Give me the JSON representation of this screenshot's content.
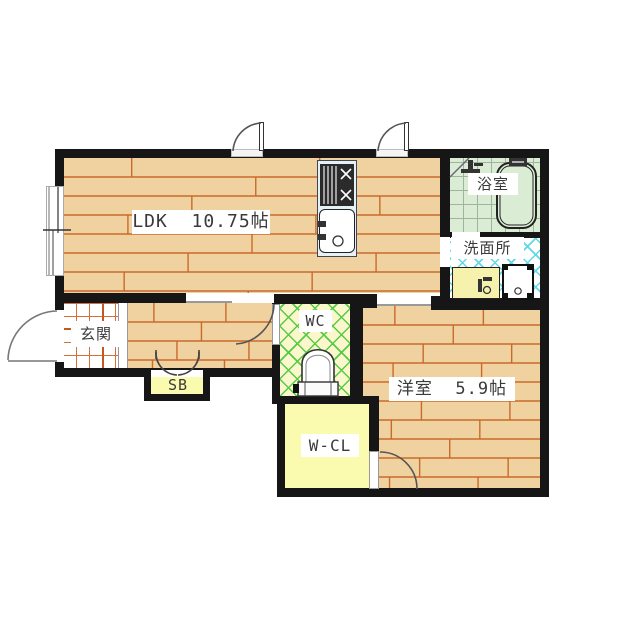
{
  "plan": {
    "rooms": {
      "ldk": {
        "label": "LDK  10.75帖",
        "floor": "wood-flooring"
      },
      "bathroom": {
        "label": "浴室",
        "floor": "tile-grid"
      },
      "washroom": {
        "label": "洗面所",
        "floor": "cyan-lattice"
      },
      "entrance": {
        "label": "玄関",
        "floor": "tile-grid"
      },
      "shoe_box": {
        "label": "SB"
      },
      "wc": {
        "label": "WC",
        "floor": "green-lattice"
      },
      "western_room": {
        "label": "洋室  5.9帖",
        "floor": "wood-flooring"
      },
      "walk_in_closet": {
        "label": "W-CL"
      }
    },
    "fixtures": [
      "bathtub",
      "shower-faucet",
      "kitchen-stove",
      "kitchen-sink",
      "vanity-sink",
      "washing-machine-pan",
      "toilet",
      "window",
      "door-swing"
    ],
    "colors": {
      "wall": "#161616",
      "wood": "#F0D1A0",
      "wood_line": "#C96A2A",
      "bath_floor": "#DAEDD4",
      "bath_grid": "#9FB49F",
      "lattice_cyan": "#5FD8E8",
      "lattice_green": "#55CC44",
      "wc_floor": "#FAF7CC",
      "closet_yellow": "#FBFBB0",
      "vanity_yellow": "#F6F2AE",
      "counter_blue": "#E4F2F7",
      "genkan_grid": "#D2703A",
      "arc_stroke": "#555555"
    }
  }
}
